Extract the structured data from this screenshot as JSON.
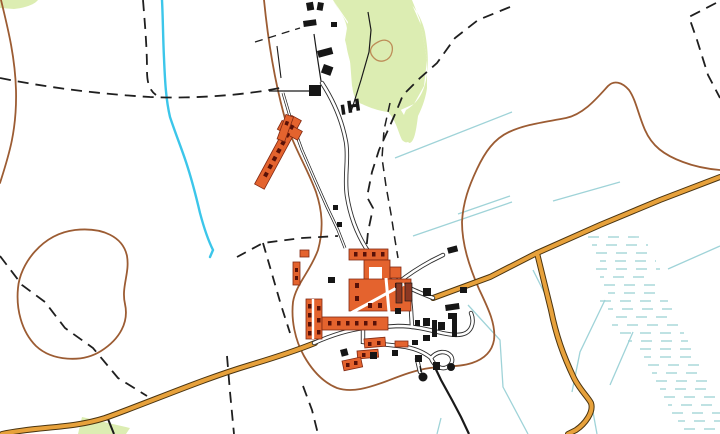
{
  "app": {
    "type": "map-viewer",
    "description": "Topographic map extract of a small linear village with farm complex, orange classified roads, stream, drains and marsh symbols"
  },
  "map": {
    "colors": {
      "background": "#ffffff",
      "woodland": "#dcedb2",
      "road_fill": "#e7a13b",
      "road_casing": "#4a3410",
      "village_road_fill": "#ffffff",
      "village_road_casing": "#2e2e2e",
      "building_orange": "#e4632e",
      "building_orange_outline": "#802812",
      "building_mark": "#591108",
      "building_dark_red": "#8c3823",
      "building_black": "#161616",
      "boundary_brown": "#9c5c33",
      "loop_tan": "#bd8d58",
      "stream_blue": "#3cc6ea",
      "drain_blue": "#9fd3d8",
      "marsh_blue": "#aad8da",
      "path_black": "#1f1f1f",
      "track_black": "#1a1a1a"
    },
    "legend_features": [
      "woodland-area",
      "stream",
      "drainage-ditch",
      "marsh-symbols",
      "field-boundary-dashed",
      "brown-boundary-line",
      "orange-road",
      "village-street",
      "farm-building-orange",
      "building-black"
    ]
  }
}
